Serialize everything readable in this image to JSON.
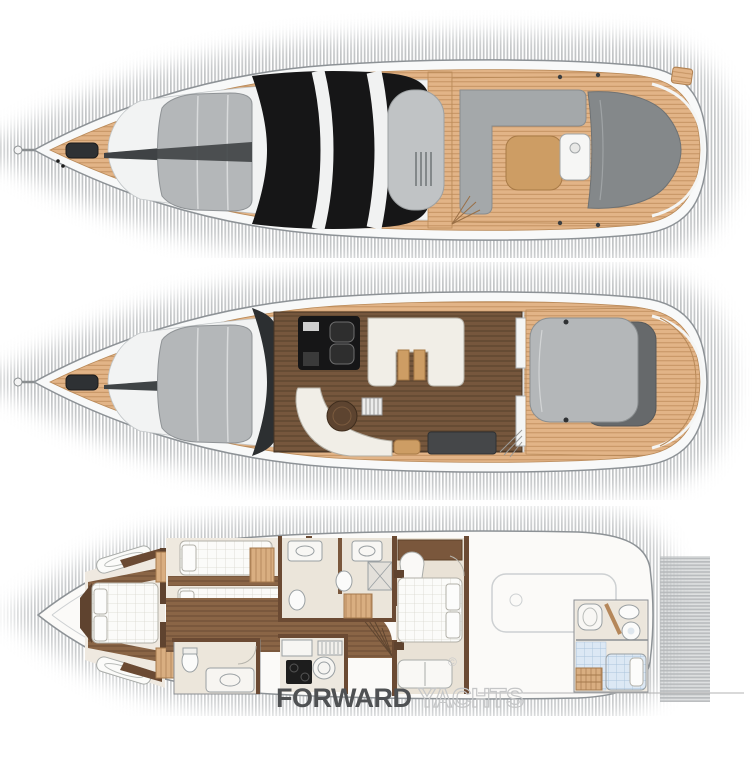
{
  "image_kind": "yacht deck plans illustration",
  "watermark": {
    "brand_bold": "FORWARD",
    "brand_light": "YACHTS",
    "copyright_mark": "©"
  },
  "decks": [
    {
      "name": "Flybridge and exterior top view"
    },
    {
      "name": "Main deck saloon and cockpit plan"
    },
    {
      "name": "Lower deck cabins plan"
    }
  ],
  "colors": {
    "page_bg": "#ffffff",
    "shadow_stripe": "#b5b8ba",
    "hull_white": "#f8f9f9",
    "hull_outline": "#8d9296",
    "superstructure_white": "#f2f3f3",
    "teak": "#e2b487",
    "teak_line": "#c2905f",
    "sunpad_gray": "#b4b7b9",
    "sunpad_dark": "#84888a",
    "canopy_black": "#161617",
    "hardtop_gray": "#c0c3c5",
    "seat_gray": "#a4a8aa",
    "table_wood": "#cd9d64",
    "salon_floor": "#76573d",
    "salon_floor_line": "#57402c",
    "corridor_wood": "#8a6546",
    "corridor_wood_line": "#6a4c34",
    "cream_sofa": "#f1eee7",
    "interior_floor": "#efe9e0",
    "wall_brown": "#5f432f",
    "wardrobe_tan": "#d9ae81",
    "wardrobe_line": "#b5875a",
    "bed_white": "#fbfbf9",
    "bed_grid": "#d9d7cf",
    "tile_blue": "#dce8f4",
    "tile_line": "#abc4db",
    "fixture_outline": "#9aa0a3",
    "tender_outline": "#cdd0d2",
    "watermark_bold": "#4f5153",
    "watermark_light": "#c5c6c7"
  }
}
